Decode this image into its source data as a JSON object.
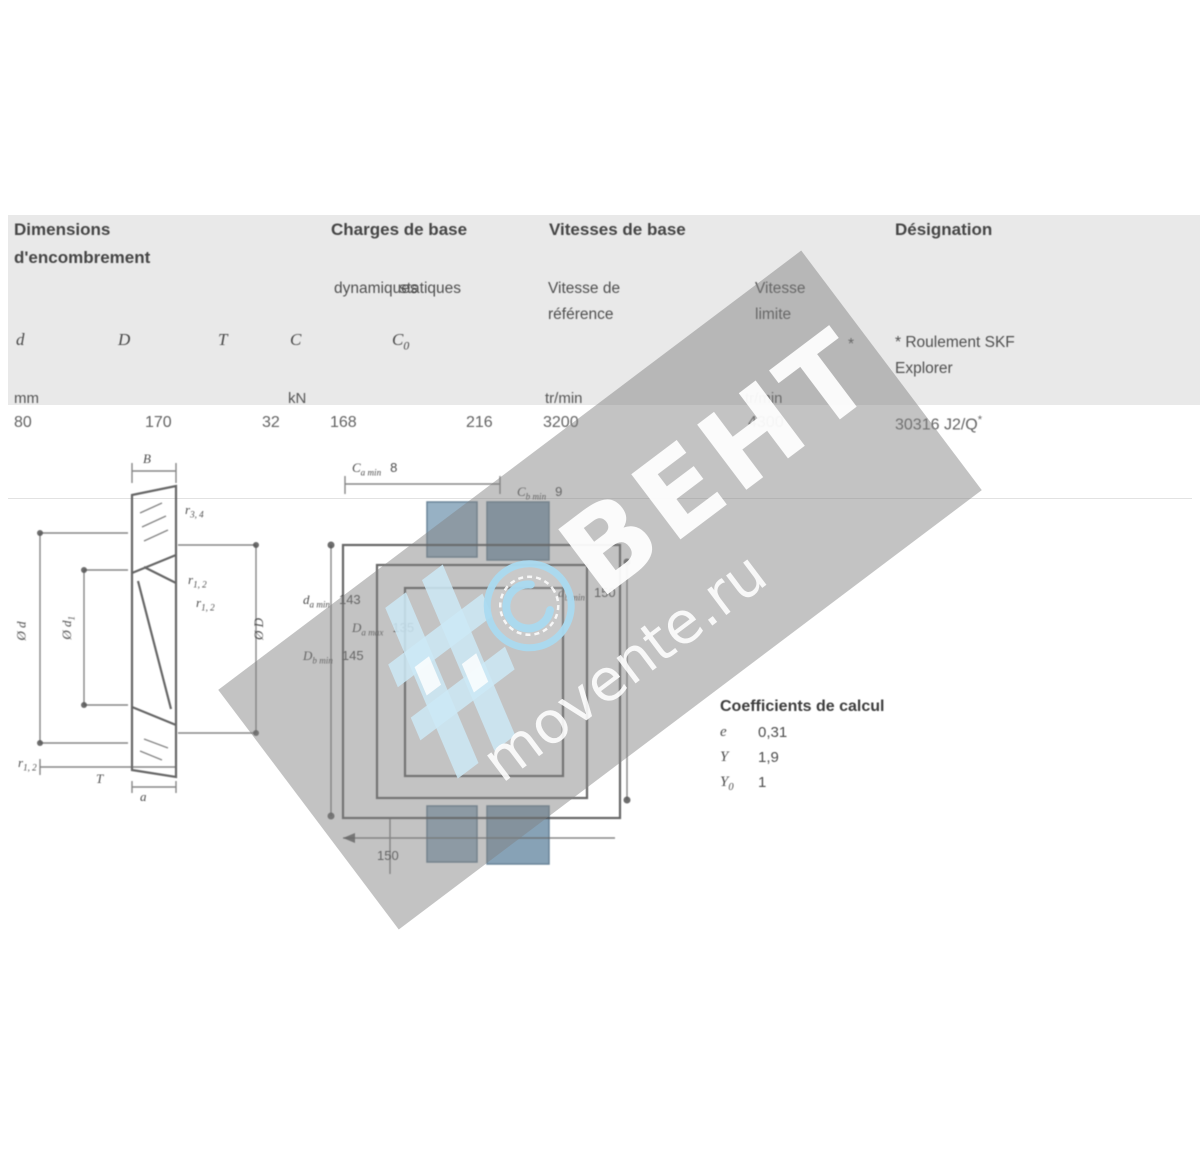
{
  "table": {
    "group1_line1": "Dimensions",
    "group1_line2": "d'encombrement",
    "group2": "Charges de base",
    "group2_sub1": "dynamiques",
    "group2_sub2": "statiques",
    "group3": "Vitesses de base",
    "group3_sub1a": "Vitesse de",
    "group3_sub1b": "référence",
    "group3_sub2a": "Vitesse",
    "group3_sub2b": "limite",
    "group4": "Désignation",
    "star_marker": "*",
    "note_line1": "* Roulement SKF",
    "note_line2": "Explorer",
    "col_d": "d",
    "col_D": "D",
    "col_T": "T",
    "col_C": "C",
    "col_C0": "C",
    "col_C0_sub": "0",
    "unit_mm": "mm",
    "unit_kN": "kN",
    "unit_rpm1": "tr/min",
    "unit_rpm2": "tr/min",
    "val_d": "80",
    "val_D": "170",
    "val_T": "32",
    "val_C": "168",
    "val_C0": "216",
    "val_vref": "3200",
    "val_vlim": "4300",
    "val_designation": "30316 J2/Q",
    "val_designation_star": "*"
  },
  "figure_left": {
    "b": {
      "pre": "B"
    },
    "r34": {
      "pre": "r",
      "sub": "3, 4"
    },
    "r12a": {
      "pre": "r",
      "sub": "1, 2"
    },
    "r12b": {
      "pre": "r",
      "sub": "1, 2"
    },
    "dd": {
      "pre": "Ø d"
    },
    "dd1": {
      "pre": "Ø d",
      "sub": "1"
    },
    "dD": {
      "pre": "Ø D"
    },
    "r12c": {
      "pre": "r",
      "sub": "1, 2"
    },
    "t": {
      "pre": "T"
    },
    "a": {
      "pre": "a"
    }
  },
  "figure_middle": {
    "ca": {
      "pre": "C",
      "sub": "a min",
      "val": "8"
    },
    "cb": {
      "pre": "C",
      "sub": "b min",
      "val": "9"
    },
    "da": {
      "pre": "d",
      "sub": "a min",
      "val": "143"
    },
    "Da": {
      "pre": "D",
      "sub": "a max",
      "val": "135"
    },
    "Db": {
      "pre": "D",
      "sub": "b min",
      "val": "145"
    },
    "db": {
      "pre": "d",
      "sub": "b min",
      "val": "150"
    },
    "a_bottom": {
      "val": "150"
    }
  },
  "calc": {
    "title": "Coefficients de calcul",
    "rows": [
      {
        "sym": "e",
        "sub": "",
        "val": "0,31"
      },
      {
        "sym": "Y",
        "sub": "",
        "val": "1,9"
      },
      {
        "sym": "Y",
        "sub": "0",
        "val": "1"
      }
    ]
  },
  "watermark": {
    "line1": "BEHT",
    "line2": "movente.ru"
  },
  "colors": {
    "band": "#e9e9e9",
    "steel_block_light": "#97b1c4",
    "steel_block_dark": "#87a2b6",
    "wm_blue": "#bfe0f0"
  }
}
